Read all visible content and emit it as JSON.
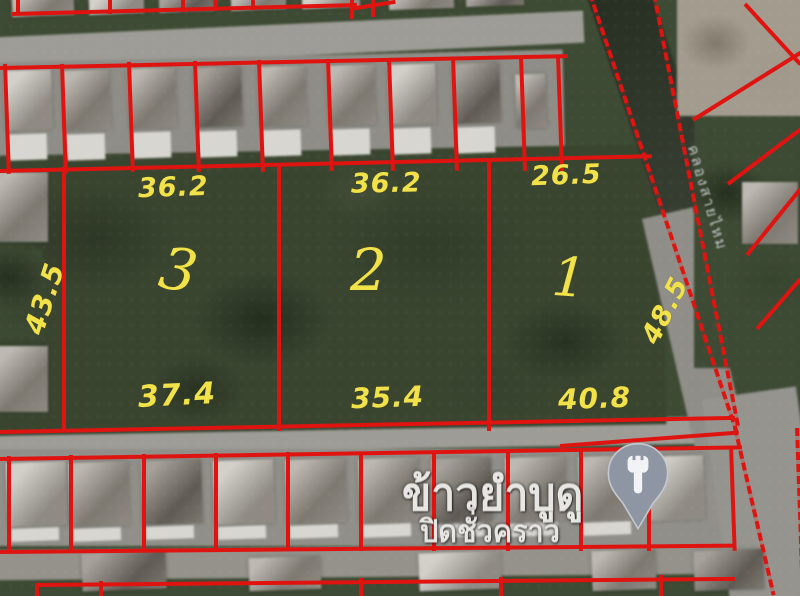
{
  "annotation": {
    "plots": [
      {
        "number": "1",
        "top_length": "26.5",
        "bottom_length": "40.8",
        "side_length": "48.5",
        "side_position": "right"
      },
      {
        "number": "2",
        "top_length": "36.2",
        "bottom_length": "35.4"
      },
      {
        "number": "3",
        "top_length": "36.2",
        "bottom_length": "37.4",
        "side_length": "43.5",
        "side_position": "left"
      }
    ]
  },
  "poi": {
    "name": "ข้าวยำบูดู",
    "status": "ปิดชั่วคราว",
    "icon": "restaurant-pin-icon"
  },
  "road": {
    "label": "คลองสายไหม"
  },
  "colors": {
    "boundary_red": "#df1411",
    "measure_yellow": "#f2e24a",
    "poi_text": "#e7e6e3",
    "pin_gray": "#8e96a4"
  }
}
